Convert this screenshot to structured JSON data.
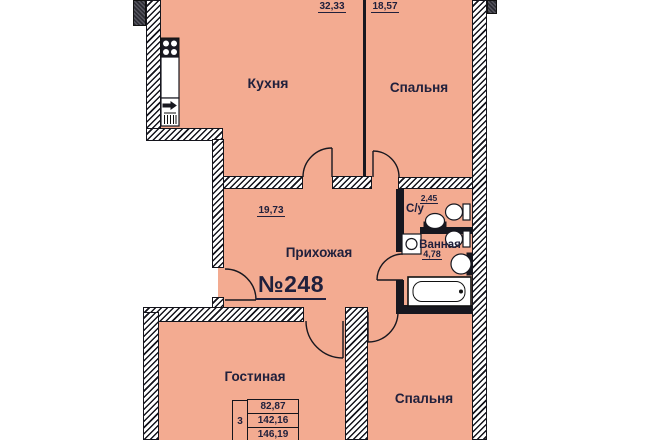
{
  "plan": {
    "apartment_number": "№248",
    "kitchen": {
      "name": "Кухня",
      "area": "32,33"
    },
    "bedroom_top": {
      "name": "Спальня",
      "area": "18,57"
    },
    "hallway": {
      "name": "Прихожая",
      "area": "19,73"
    },
    "wc": {
      "name": "С/у",
      "area": "2,45"
    },
    "bathroom": {
      "name": "Ванная",
      "area": "4,78"
    },
    "living_room": {
      "name": "Гостиная"
    },
    "bedroom_bottom": {
      "name": "Спальня"
    },
    "stamp": {
      "rooms_count": "3",
      "values": [
        "82,87",
        "142,16",
        "146,19"
      ]
    },
    "colors": {
      "room_fill": "#F3AB91",
      "label_text": "#20203C",
      "wall_hatch": "#14141C"
    },
    "icons": [
      "stove-icon",
      "kitchen-sink-icon",
      "toilet-icon",
      "washbasin-icon",
      "washing-machine-icon",
      "bathtub-icon",
      "door-arc-icon"
    ]
  }
}
